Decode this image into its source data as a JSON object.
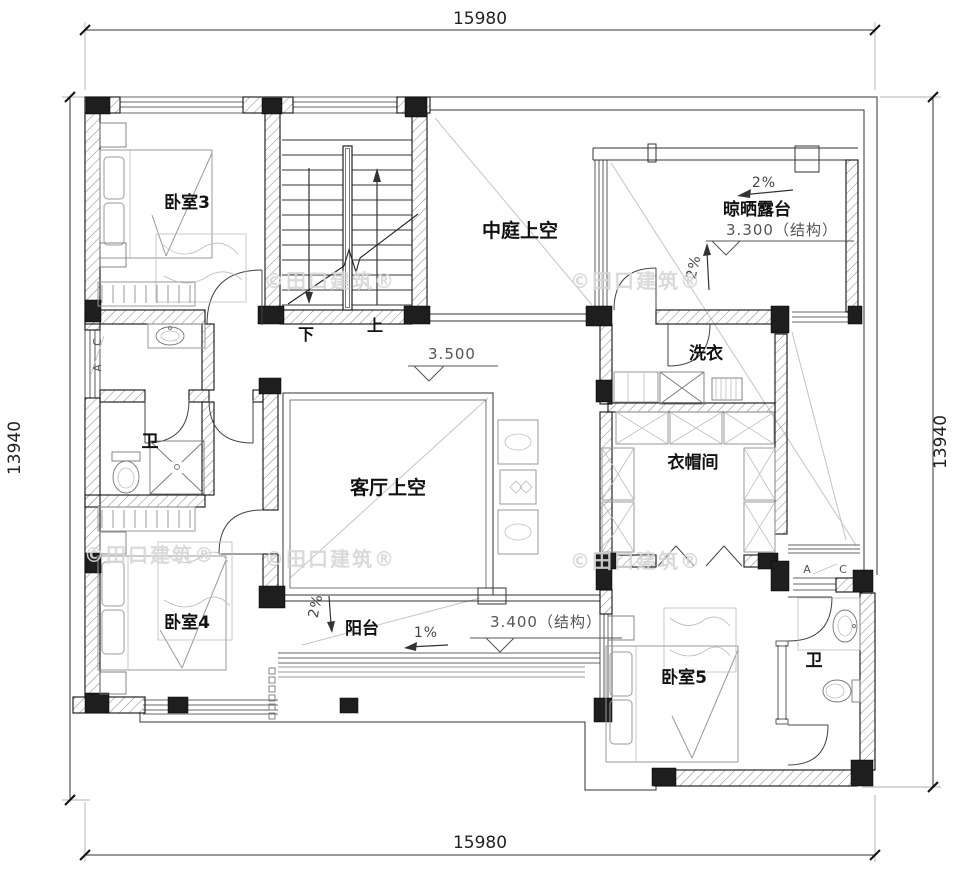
{
  "dimensions": {
    "top": "15980",
    "bottom": "15980",
    "left": "13940",
    "right": "13940"
  },
  "rooms": {
    "bedroom3": "卧室3",
    "bedroom4": "卧室4",
    "bedroom5": "卧室5",
    "atrium_void": "中庭上空",
    "living_void": "客厅上空",
    "drying_terrace": "晾晒露台",
    "laundry": "洗衣",
    "closet": "衣帽间",
    "balcony": "阳台",
    "bath_left": "卫",
    "bath_right": "卫"
  },
  "levels": {
    "second_floor": "3.500",
    "terrace": "3.300（结构）",
    "balcony": "3.400（结构）"
  },
  "slopes": {
    "terrace_top": "2%",
    "terrace_side": "2%",
    "balcony_side": "2%",
    "balcony_main": "1%"
  },
  "stairs": {
    "down_label": "下",
    "up_label": "上"
  },
  "window_tags": {
    "a": "A",
    "c": "C"
  },
  "watermark": {
    "text": "©田口建筑®"
  },
  "colors": {
    "wall_fill": "#1e1e1e",
    "line": "#333333",
    "hatch": "#8f8f8f",
    "furniture": "#9a9a9a",
    "annotation": "#555555",
    "watermark": "#d6d6d6",
    "background": "#ffffff"
  }
}
